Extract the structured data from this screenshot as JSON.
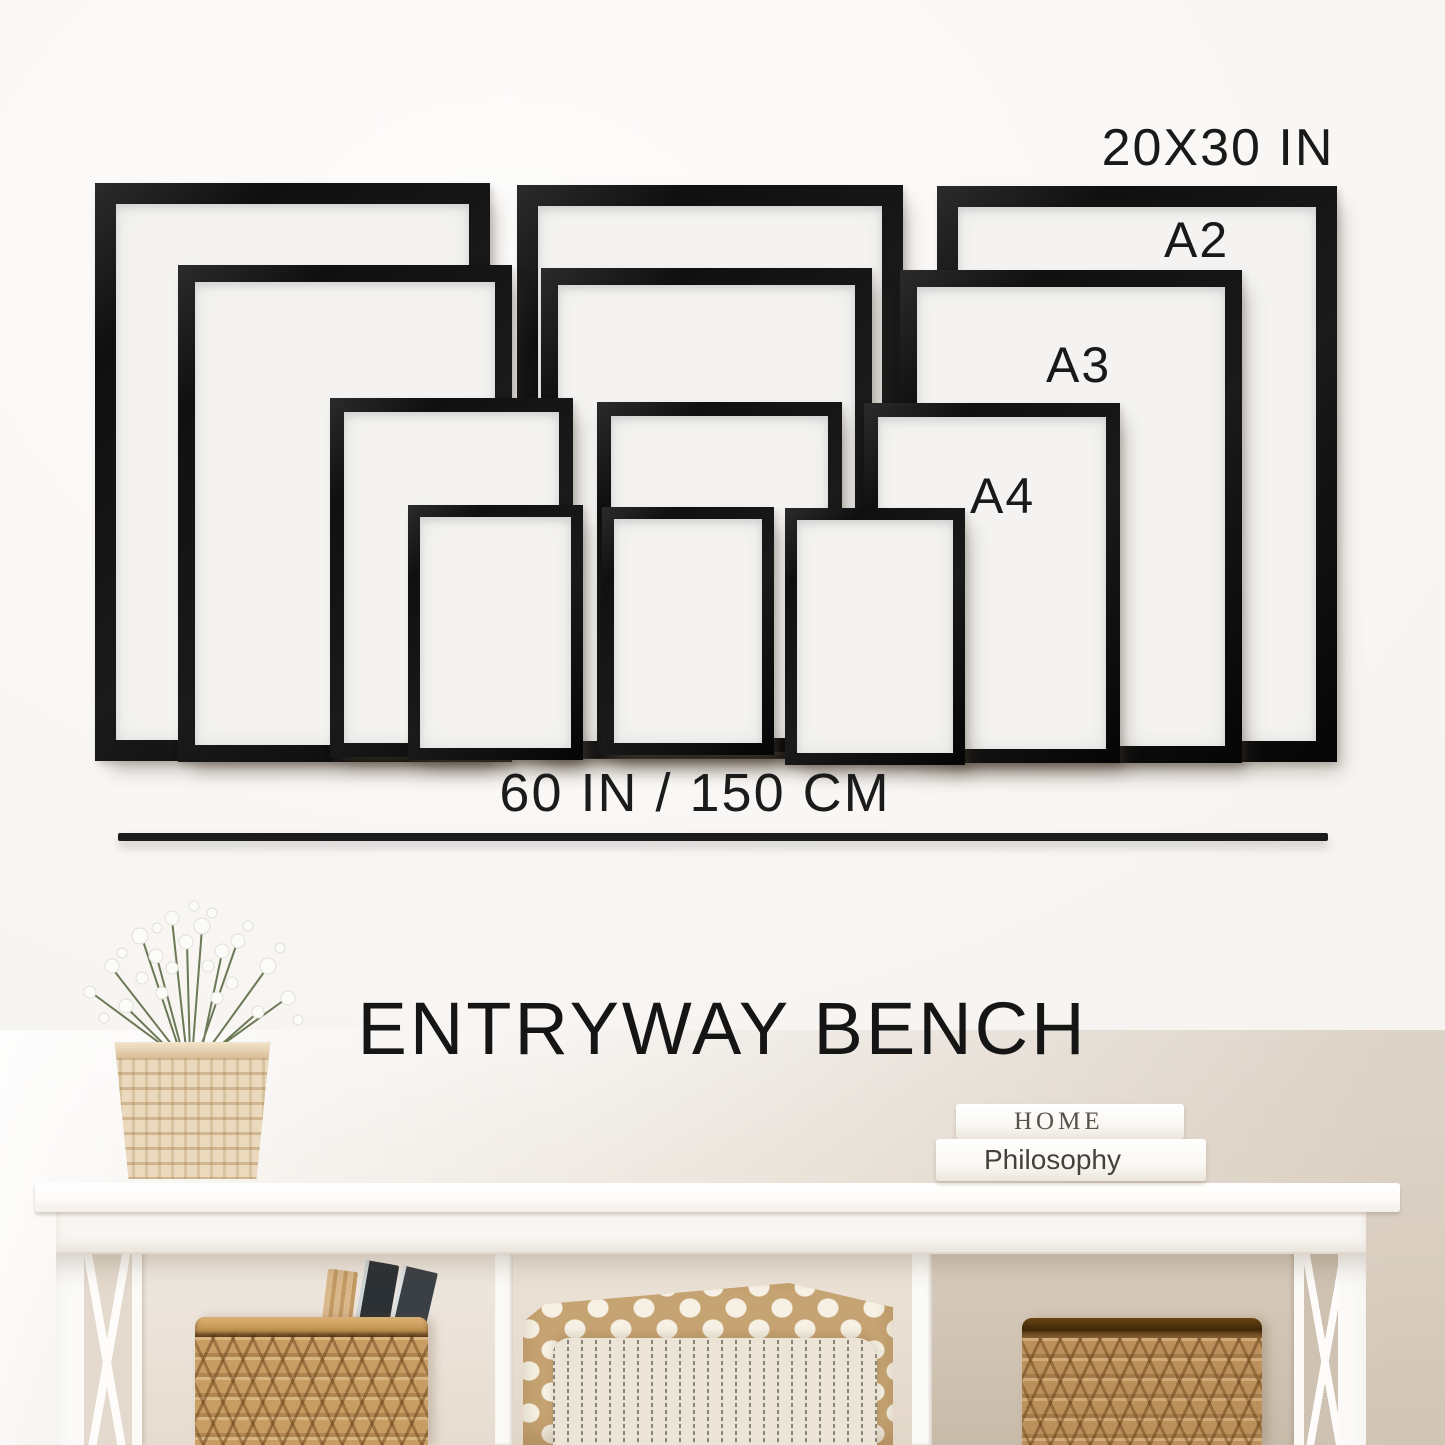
{
  "size_chart": {
    "type": "frame-size-comparison",
    "frame_color": "#161616",
    "paper_color": "#f4f3f1",
    "sizes": [
      {
        "name": "20x30",
        "label": "20X30 IN",
        "border": 21,
        "rects": [
          [
            95,
            183,
            395,
            578
          ],
          [
            517,
            185,
            386,
            574
          ],
          [
            937,
            186,
            400,
            576
          ]
        ]
      },
      {
        "name": "a2",
        "label": "A2",
        "border": 17,
        "rects": [
          [
            178,
            265,
            334,
            497
          ],
          [
            541,
            268,
            331,
            490
          ],
          [
            900,
            270,
            342,
            493
          ]
        ]
      },
      {
        "name": "a3",
        "label": "A3",
        "border": 14,
        "rects": [
          [
            330,
            398,
            243,
            359
          ],
          [
            597,
            402,
            245,
            350
          ],
          [
            864,
            403,
            256,
            360
          ]
        ]
      },
      {
        "name": "a4",
        "label": "A4",
        "border": 12,
        "rects": [
          [
            408,
            505,
            175,
            255
          ],
          [
            602,
            507,
            172,
            248
          ],
          [
            785,
            508,
            180,
            257
          ]
        ]
      }
    ],
    "width_caption": "60 IN / 150 CM"
  },
  "caption": {
    "title": "ENTRYWAY BENCH"
  },
  "photo": {
    "books": {
      "top": "HOME",
      "bottom": "Philosophy"
    }
  },
  "colors": {
    "wall_white": "#faf8f6",
    "wall_beige": "#d6cabc",
    "frame_black": "#161616",
    "basket_tan": "#c89d63",
    "pillow_polka_tan": "#c6a372",
    "pillow_stripe_cream": "#ece5d7",
    "text_black": "#1b1b1b"
  }
}
